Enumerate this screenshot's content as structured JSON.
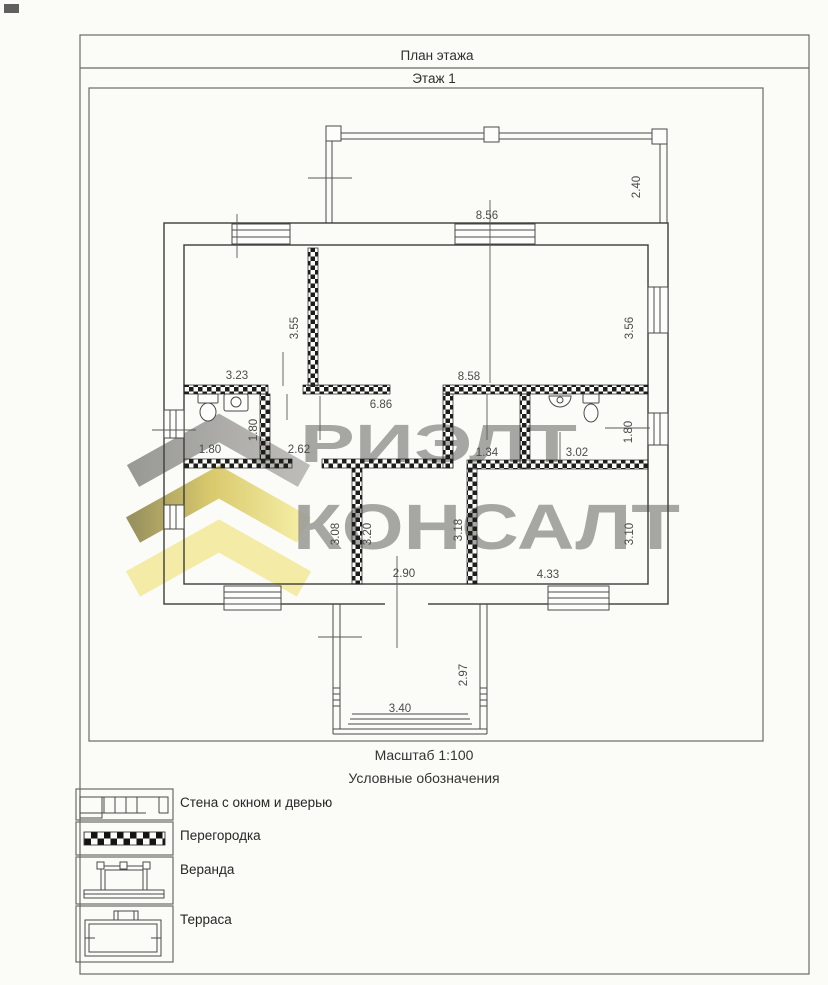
{
  "header": {
    "title": "План этажа",
    "floor": "Этаж 1"
  },
  "footer": {
    "scale": "Масштаб 1:100",
    "legend_title": "Условные обозначения"
  },
  "legend": {
    "items": [
      {
        "label": "Стена с окном и дверью"
      },
      {
        "label": "Перегородка"
      },
      {
        "label": "Веранда"
      },
      {
        "label": "Терраса"
      }
    ]
  },
  "watermark": {
    "line1": "РИЭЛТ",
    "line2": "КОНСАЛТ",
    "text_color": "#90908c",
    "chevron_gray": "#a5a4a0",
    "chevron_gold": "#dcc961",
    "chevron_pale": "#f4eb9e"
  },
  "dims": {
    "veranda_w": "8.56",
    "veranda_h": "2.40",
    "room_tl_w": "3.23",
    "room_tl_h": "3.55",
    "living_w": "8.58",
    "living_h": "3.56",
    "hall_len": "6.86",
    "wc_left_w": "1.80",
    "wc_left_h": "1.80",
    "hall_left_w": "2.62",
    "hall_right_w": "1.34",
    "wc_right_w": "3.02",
    "wc_right_h": "1.80",
    "room_bl_h": "3.08",
    "room_bm_h_left": "3.20",
    "room_bm_w": "2.90",
    "room_bm_h_right": "3.18",
    "room_br_w": "4.33",
    "room_br_h": "3.10",
    "terrace_h": "2.97",
    "terrace_w": "3.40"
  }
}
